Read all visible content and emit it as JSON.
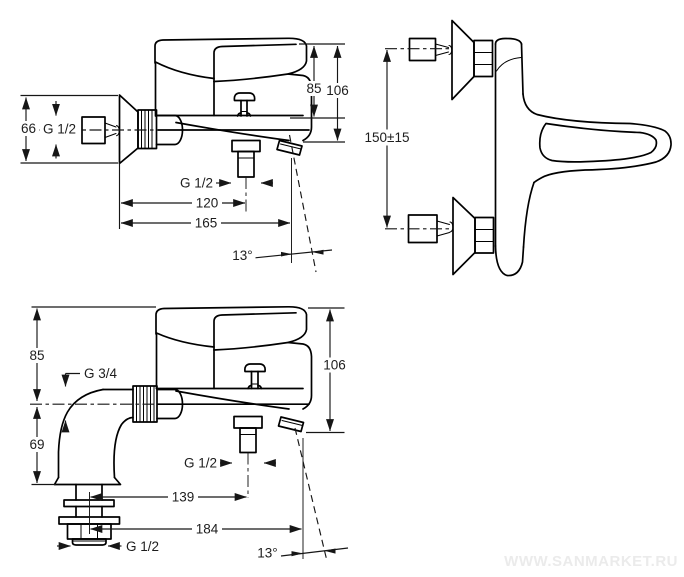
{
  "watermark": {
    "text": "WWW.SANMARKET.RU"
  },
  "views": {
    "wall_side": {
      "labels": {
        "h85": "85",
        "h106": "106",
        "flange66": "66",
        "inlet_thread": "G 1/2",
        "outlet_thread": "G 1/2",
        "d120": "120",
        "d165": "165",
        "angle": "13°"
      }
    },
    "plan": {
      "labels": {
        "spacing": "150±15"
      }
    },
    "deck_side": {
      "labels": {
        "h85": "85",
        "h69": "69",
        "inlet_thread": "G 3/4",
        "h106": "106",
        "outlet_thread": "G 1/2",
        "d139": "139",
        "d184": "184",
        "angle": "13°",
        "stem_thread": "G 1/2"
      }
    }
  }
}
